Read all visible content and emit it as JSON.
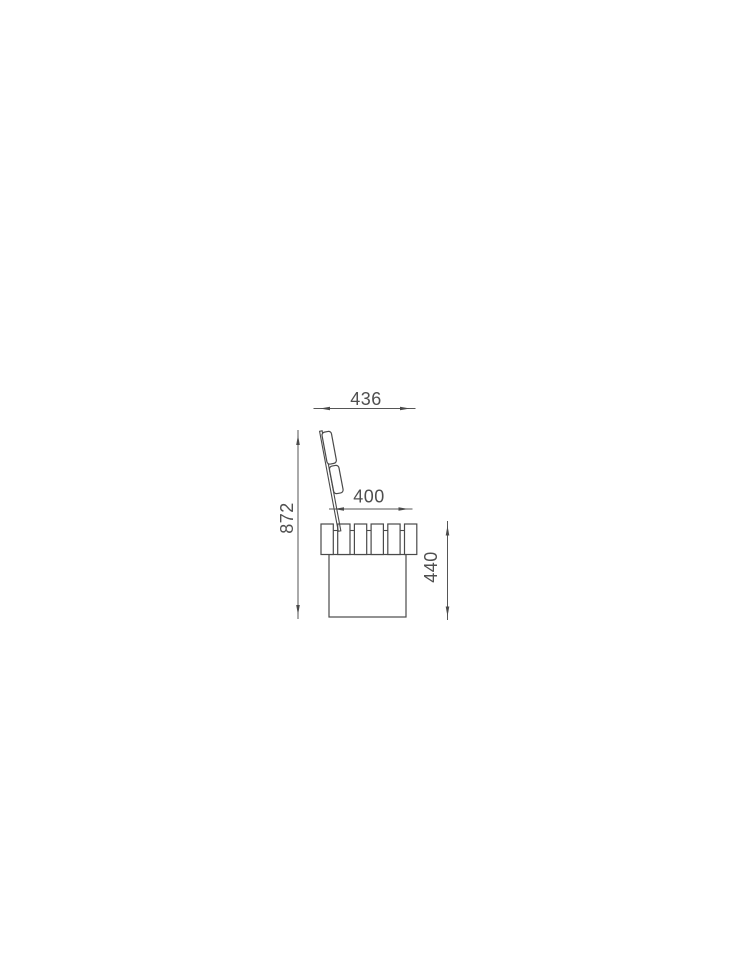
{
  "page": {
    "background": "#ffffff",
    "content": "technical side-elevation drawing of a bench with slatted seat, angled slatted backrest and solid base block"
  },
  "drawing": {
    "line_color": "#4a4a4a",
    "dimension_line_color": "#565656",
    "text_color": "#4f4f4f",
    "dimensions": {
      "overall_depth": "436",
      "seat_depth": "400",
      "overall_height": "872",
      "seat_height": "440"
    }
  }
}
